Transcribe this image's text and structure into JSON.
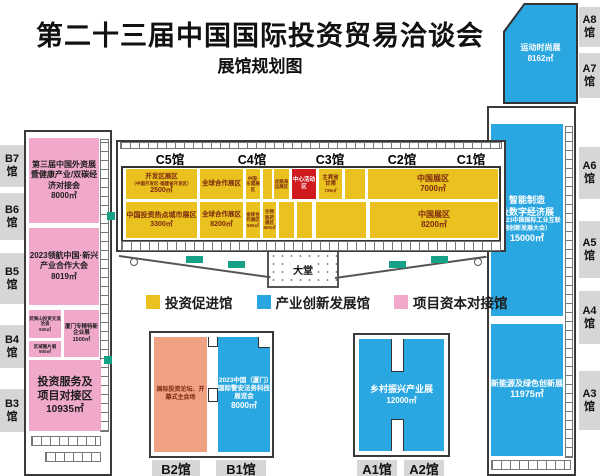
{
  "title": "第二十三届中国国际投资贸易洽谈会",
  "subtitle": "展馆规划图",
  "legend": [
    {
      "label": "投资促进馆",
      "color": "#e9c21f"
    },
    {
      "label": "产业创新发展馆",
      "color": "#2aa7e0"
    },
    {
      "label": "项目资本对接馆",
      "color": "#f0a9cb"
    }
  ],
  "halls": {
    "left": [
      "B7馆",
      "B6馆",
      "B5馆",
      "B4馆",
      "B3馆"
    ],
    "right": [
      "A8馆",
      "A7馆",
      "A6馆",
      "A5馆",
      "A4馆",
      "A3馆"
    ],
    "bottom": [
      "B2馆",
      "B1馆",
      "A1馆",
      "A2馆"
    ]
  },
  "c_headers": [
    "C5馆",
    "C4馆",
    "C3馆",
    "C2馆",
    "C1馆"
  ],
  "zones": {
    "sports": {
      "name": "运动时尚展",
      "area": "8162㎡"
    },
    "smart": {
      "name1": "智能制造",
      "name2": "及数字经济展",
      "sub": "（2023中国国际工业互联网创新发展大会）",
      "area": "15000㎡"
    },
    "green_energy": {
      "name": "新能源及绿色创新展",
      "area": "11975㎡"
    },
    "rural": {
      "name": "乡村振兴产业展",
      "area": "12000㎡"
    },
    "forum": {
      "name": "国际投资论坛、开幕式主会场"
    },
    "legal": {
      "name": "2023中国（厦门）国际警安法务科技展览会",
      "area": "8000㎡"
    },
    "foreign_invest": {
      "name": "第三届中国外资展暨健康产业/双碳经济对接会",
      "area": "8000㎡"
    },
    "pilot": {
      "name": "2023领航中国·新兴产业合作大会",
      "area": "8019㎡"
    },
    "service": {
      "name1": "投资服务及",
      "name2": "项目对接区",
      "area": "10935㎡"
    },
    "wuyishan": {
      "name": "武夷山投资交流洽谈",
      "area": "930㎡"
    },
    "photo": {
      "name": "区域图片展",
      "area": "500㎡"
    },
    "sme": {
      "name": "厦门专精特新企业展",
      "area": "1500㎡"
    },
    "kaifaqu": {
      "name": "开发区展区",
      "sub": "（中国开发区·福建省开发区）",
      "area": "2500㎡"
    },
    "global1": {
      "name": "全球合作展区"
    },
    "asean": {
      "name": "中国·东盟展区"
    },
    "silk": {
      "name": "丝路海运展区"
    },
    "stage": {
      "name": "中心活动区"
    },
    "guest": {
      "name1": "主宾省",
      "name2": "甘肃",
      "area": "726㎡"
    },
    "china1": {
      "name": "中国展区",
      "area": "7000㎡"
    },
    "hotcity": {
      "name": "中国投资热点城市展区",
      "area": "3300㎡"
    },
    "global2": {
      "name": "全球合作展区",
      "area": "8200㎡"
    },
    "brics": {
      "name": "金砖合作展区",
      "area": "500㎡"
    },
    "bio": {
      "name": "生物医药展区",
      "area": "500㎡"
    },
    "china2": {
      "name": "中国展区",
      "area": "8200㎡"
    },
    "lobby": {
      "name": "大堂"
    }
  }
}
